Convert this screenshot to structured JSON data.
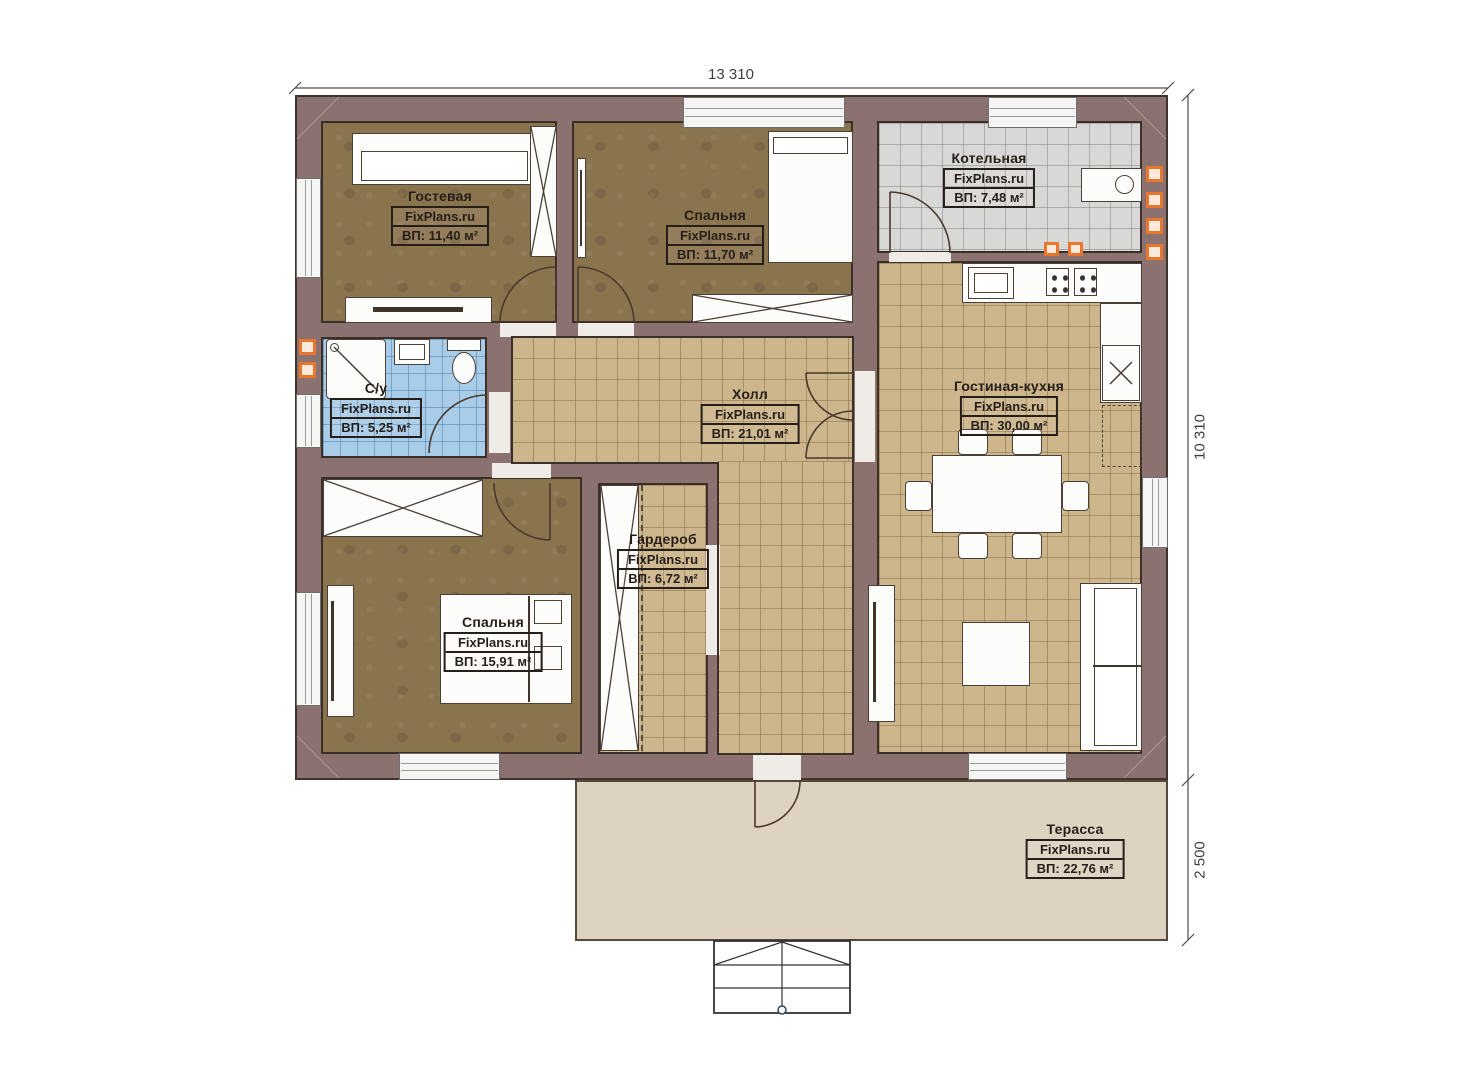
{
  "plan": {
    "brand": "FixPlans.ru",
    "rooms": [
      {
        "id": "guest",
        "name": "Гостевая",
        "brand": "FixPlans.ru",
        "area": "ВП: 11,40 м²"
      },
      {
        "id": "bedroom-top",
        "name": "Спальня",
        "brand": "FixPlans.ru",
        "area": "ВП: 11,70 м²"
      },
      {
        "id": "boiler",
        "name": "Котельная",
        "brand": "FixPlans.ru",
        "area": "ВП: 7,48 м²"
      },
      {
        "id": "bathroom",
        "name": "С/у",
        "brand": "FixPlans.ru",
        "area": "ВП: 5,25 м²"
      },
      {
        "id": "hall",
        "name": "Холл",
        "brand": "FixPlans.ru",
        "area": "ВП: 21,01 м²"
      },
      {
        "id": "living-kitchen",
        "name": "Гостиная-кухня",
        "brand": "FixPlans.ru",
        "area": "ВП: 30,00 м²"
      },
      {
        "id": "wardrobe",
        "name": "Гардероб",
        "brand": "FixPlans.ru",
        "area": "ВП: 6,72 м²"
      },
      {
        "id": "bedroom-main",
        "name": "Спальня",
        "brand": "FixPlans.ru",
        "area": "ВП: 15,91 м²"
      },
      {
        "id": "terrace",
        "name": "Терасса",
        "brand": "FixPlans.ru",
        "area": "ВП: 22,76 м²"
      }
    ],
    "dimensions": {
      "top_width": "13 310",
      "right_height": "10 310",
      "terrace_depth": "2 500"
    },
    "colors": {
      "wall": "#8b7170",
      "wood_floor": "#8a744e",
      "tile_beige": "#cdb68c",
      "tile_blue": "#a9cce9",
      "tile_gray": "#d8d8d6",
      "terrace": "#ded3c0",
      "accent_orange": "#e8762c"
    }
  }
}
